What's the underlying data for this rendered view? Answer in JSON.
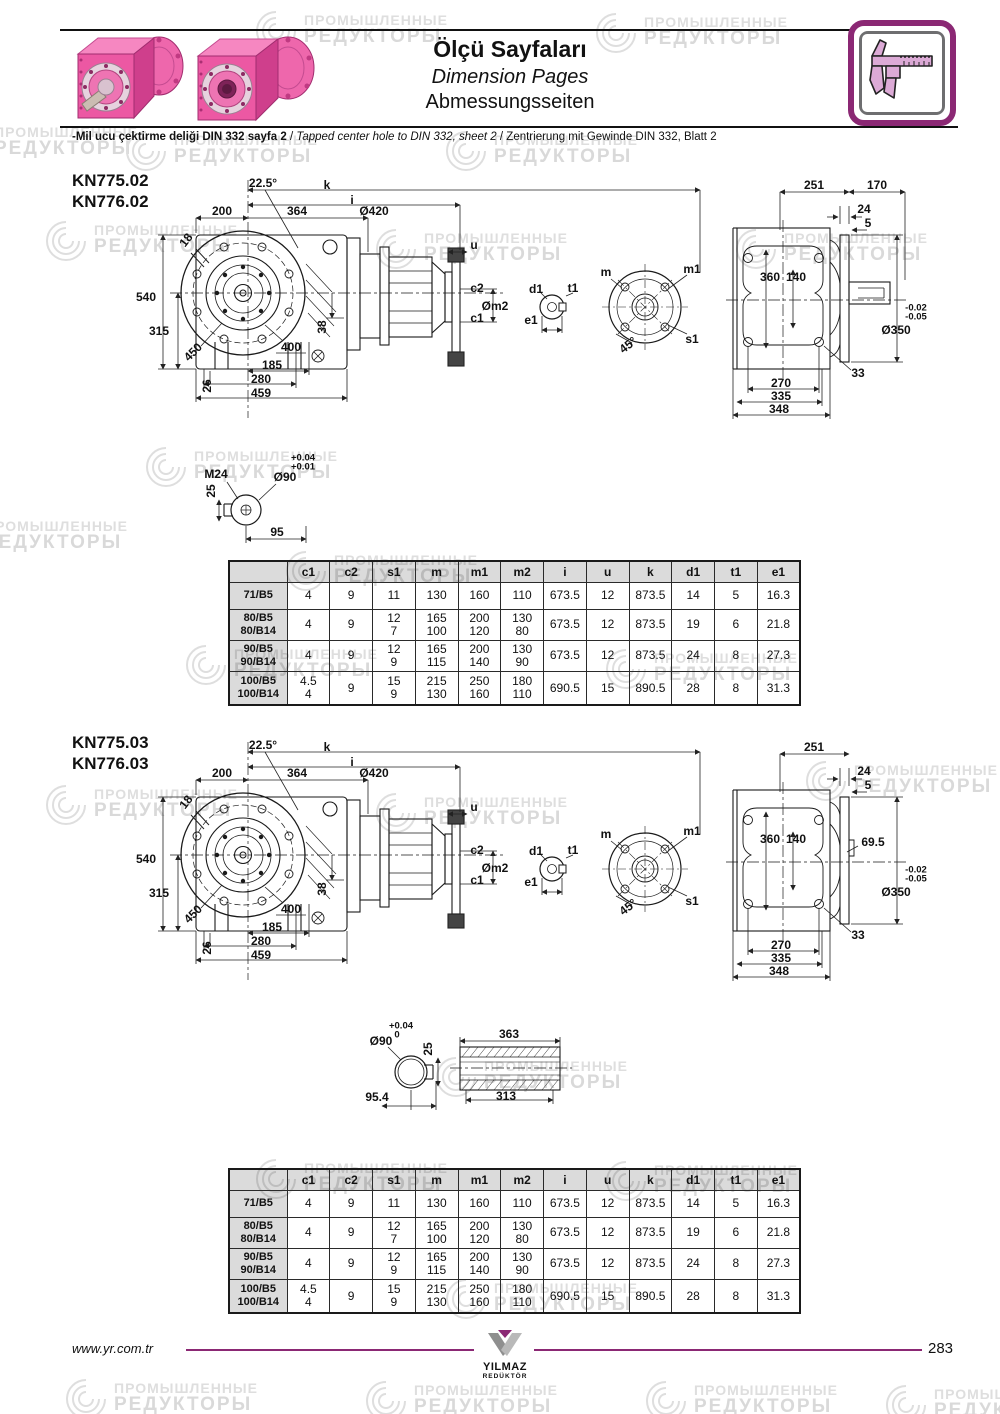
{
  "header": {
    "title_tr": "Ölçü Sayfaları",
    "title_en": "Dimension Pages",
    "title_de": "Abmessungsseiten",
    "note_tr": "-Mil ucu çektirme deliği DIN 332 sayfa 2",
    "note_en": "Tapped center hole to DIN 332, sheet 2",
    "note_de": "Zentrierung mit Gewinde DIN 332, Blatt 2",
    "sep": "/"
  },
  "watermark": {
    "line1": "ПРОМЫШЛЕННЫЕ",
    "line2": "РЕДУКТОРЫ"
  },
  "colors": {
    "accent_purple": "#8b2874",
    "brand_pink": "#ec58a3",
    "table_gray": "#dcdcdc"
  },
  "sections": [
    {
      "models": [
        "KN775.02",
        "KN776.02"
      ],
      "front": {
        "a225": "22.5°",
        "k": "k",
        "i": "i",
        "d200": "200",
        "d364": "364",
        "d420": "Ø420",
        "d18": "18",
        "d540": "540",
        "d315": "315",
        "d450": "450",
        "d400": "400",
        "d38": "38",
        "d26": "26",
        "d185": "185",
        "d280": "280",
        "d459": "459",
        "u": "u",
        "c2": "c2",
        "om2": "Øm2",
        "c1": "c1"
      },
      "key": {
        "d1": "d1",
        "t1": "t1",
        "e1": "e1"
      },
      "flange": {
        "m": "m",
        "m1": "m1",
        "a45": "45°",
        "s1": "s1"
      },
      "side": {
        "d251": "251",
        "d170": "170",
        "d24": "24",
        "d5": "5",
        "d360": "360",
        "d140": "140",
        "tol1": "-0.02",
        "tol2": "-0.05",
        "d350": "Ø350",
        "d33": "33",
        "d270": "270",
        "d335": "335",
        "d348": "348"
      },
      "shaft_detail": {
        "m24": "M24",
        "d25": "25",
        "d90": "Ø90",
        "tol_top": "+0.04",
        "tol_bot": "+0.01",
        "d95": "95"
      }
    },
    {
      "models": [
        "KN775.03",
        "KN776.03"
      ],
      "front": {
        "a225": "22.5°",
        "k": "k",
        "i": "i",
        "d200": "200",
        "d364": "364",
        "d420": "Ø420",
        "d18": "18",
        "d540": "540",
        "d315": "315",
        "d450": "450",
        "d400": "400",
        "d38": "38",
        "d26": "26",
        "d185": "185",
        "d280": "280",
        "d459": "459",
        "u": "u",
        "c2": "c2",
        "om2": "Øm2",
        "c1": "c1"
      },
      "key": {
        "d1": "d1",
        "t1": "t1",
        "e1": "e1"
      },
      "flange": {
        "m": "m",
        "m1": "m1",
        "a45": "45°",
        "s1": "s1"
      },
      "side": {
        "d251": "251",
        "d24": "24",
        "d5": "5",
        "d360": "360",
        "d140": "140",
        "d69": "69.5",
        "tol1": "-0.02",
        "tol2": "-0.05",
        "d350": "Ø350",
        "d33": "33",
        "d270": "270",
        "d335": "335",
        "d348": "348"
      },
      "hollow_detail": {
        "d90": "Ø90",
        "tol_top": "+0.04",
        "tol_bot": "0",
        "d25": "25",
        "d954": "95.4",
        "d363": "363",
        "d313": "313"
      }
    }
  ],
  "table": {
    "headers": [
      "c1",
      "c2",
      "s1",
      "m",
      "m1",
      "m2",
      "i",
      "u",
      "k",
      "d1",
      "t1",
      "e1"
    ],
    "rows": [
      {
        "name": "71/B5",
        "values": [
          "4",
          "9",
          "11",
          "130",
          "160",
          "110",
          "673.5",
          "12",
          "873.5",
          "14",
          "5",
          "16.3"
        ]
      },
      {
        "name": "80/B5\n80/B14",
        "values": [
          "4",
          "9",
          "12\n7",
          "165\n100",
          "200\n120",
          "130\n80",
          "673.5",
          "12",
          "873.5",
          "19",
          "6",
          "21.8"
        ]
      },
      {
        "name": "90/B5\n90/B14",
        "values": [
          "4",
          "9",
          "12\n9",
          "165\n115",
          "200\n140",
          "130\n90",
          "673.5",
          "12",
          "873.5",
          "24",
          "8",
          "27.3"
        ]
      },
      {
        "name": "100/B5\n100/B14",
        "values": [
          "4.5\n4",
          "9",
          "15\n9",
          "215\n130",
          "250\n160",
          "180\n110",
          "690.5",
          "15",
          "890.5",
          "28",
          "8",
          "31.3"
        ]
      }
    ]
  },
  "footer": {
    "url": "www.yr.com.tr",
    "page": "283",
    "logo_line1": "YILMAZ",
    "logo_line2": "REDÜKTÖR"
  }
}
